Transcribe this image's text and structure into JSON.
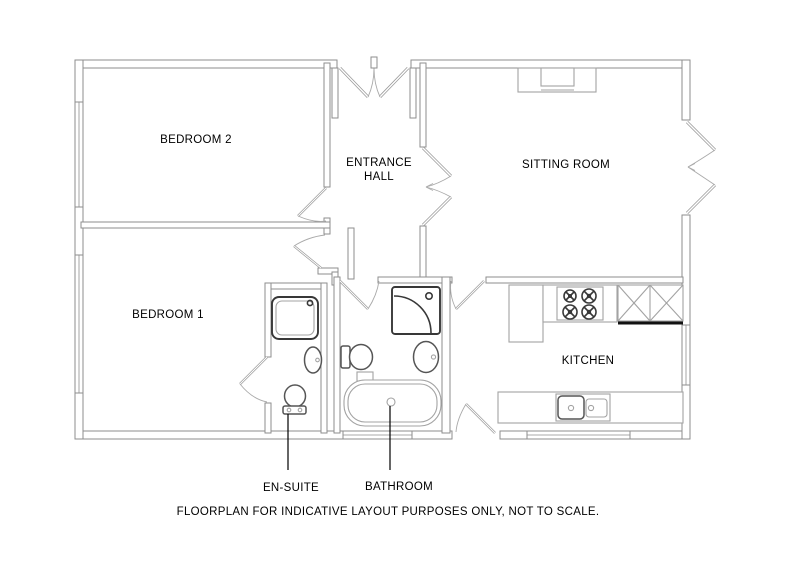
{
  "floorplan": {
    "rooms": {
      "bedroom_2": {
        "label": "BEDROOM 2"
      },
      "entrance_hall": {
        "line1": "ENTRANCE",
        "line2": "HALL"
      },
      "sitting_room": {
        "label": "SITTING ROOM"
      },
      "bedroom_1": {
        "label": "BEDROOM 1"
      },
      "kitchen": {
        "label": "KITCHEN"
      },
      "en_suite": {
        "label": "EN-SUITE"
      },
      "bathroom": {
        "label": "BATHROOM"
      }
    },
    "caption": "FLOORPLAN FOR INDICATIVE LAYOUT PURPOSES ONLY, NOT TO SCALE.",
    "colors": {
      "background": "#ffffff",
      "wall_line": "#8e8e8e",
      "fixture_line": "#a3a3a3",
      "fixture_bold": "#383838",
      "text": "#000000"
    }
  }
}
